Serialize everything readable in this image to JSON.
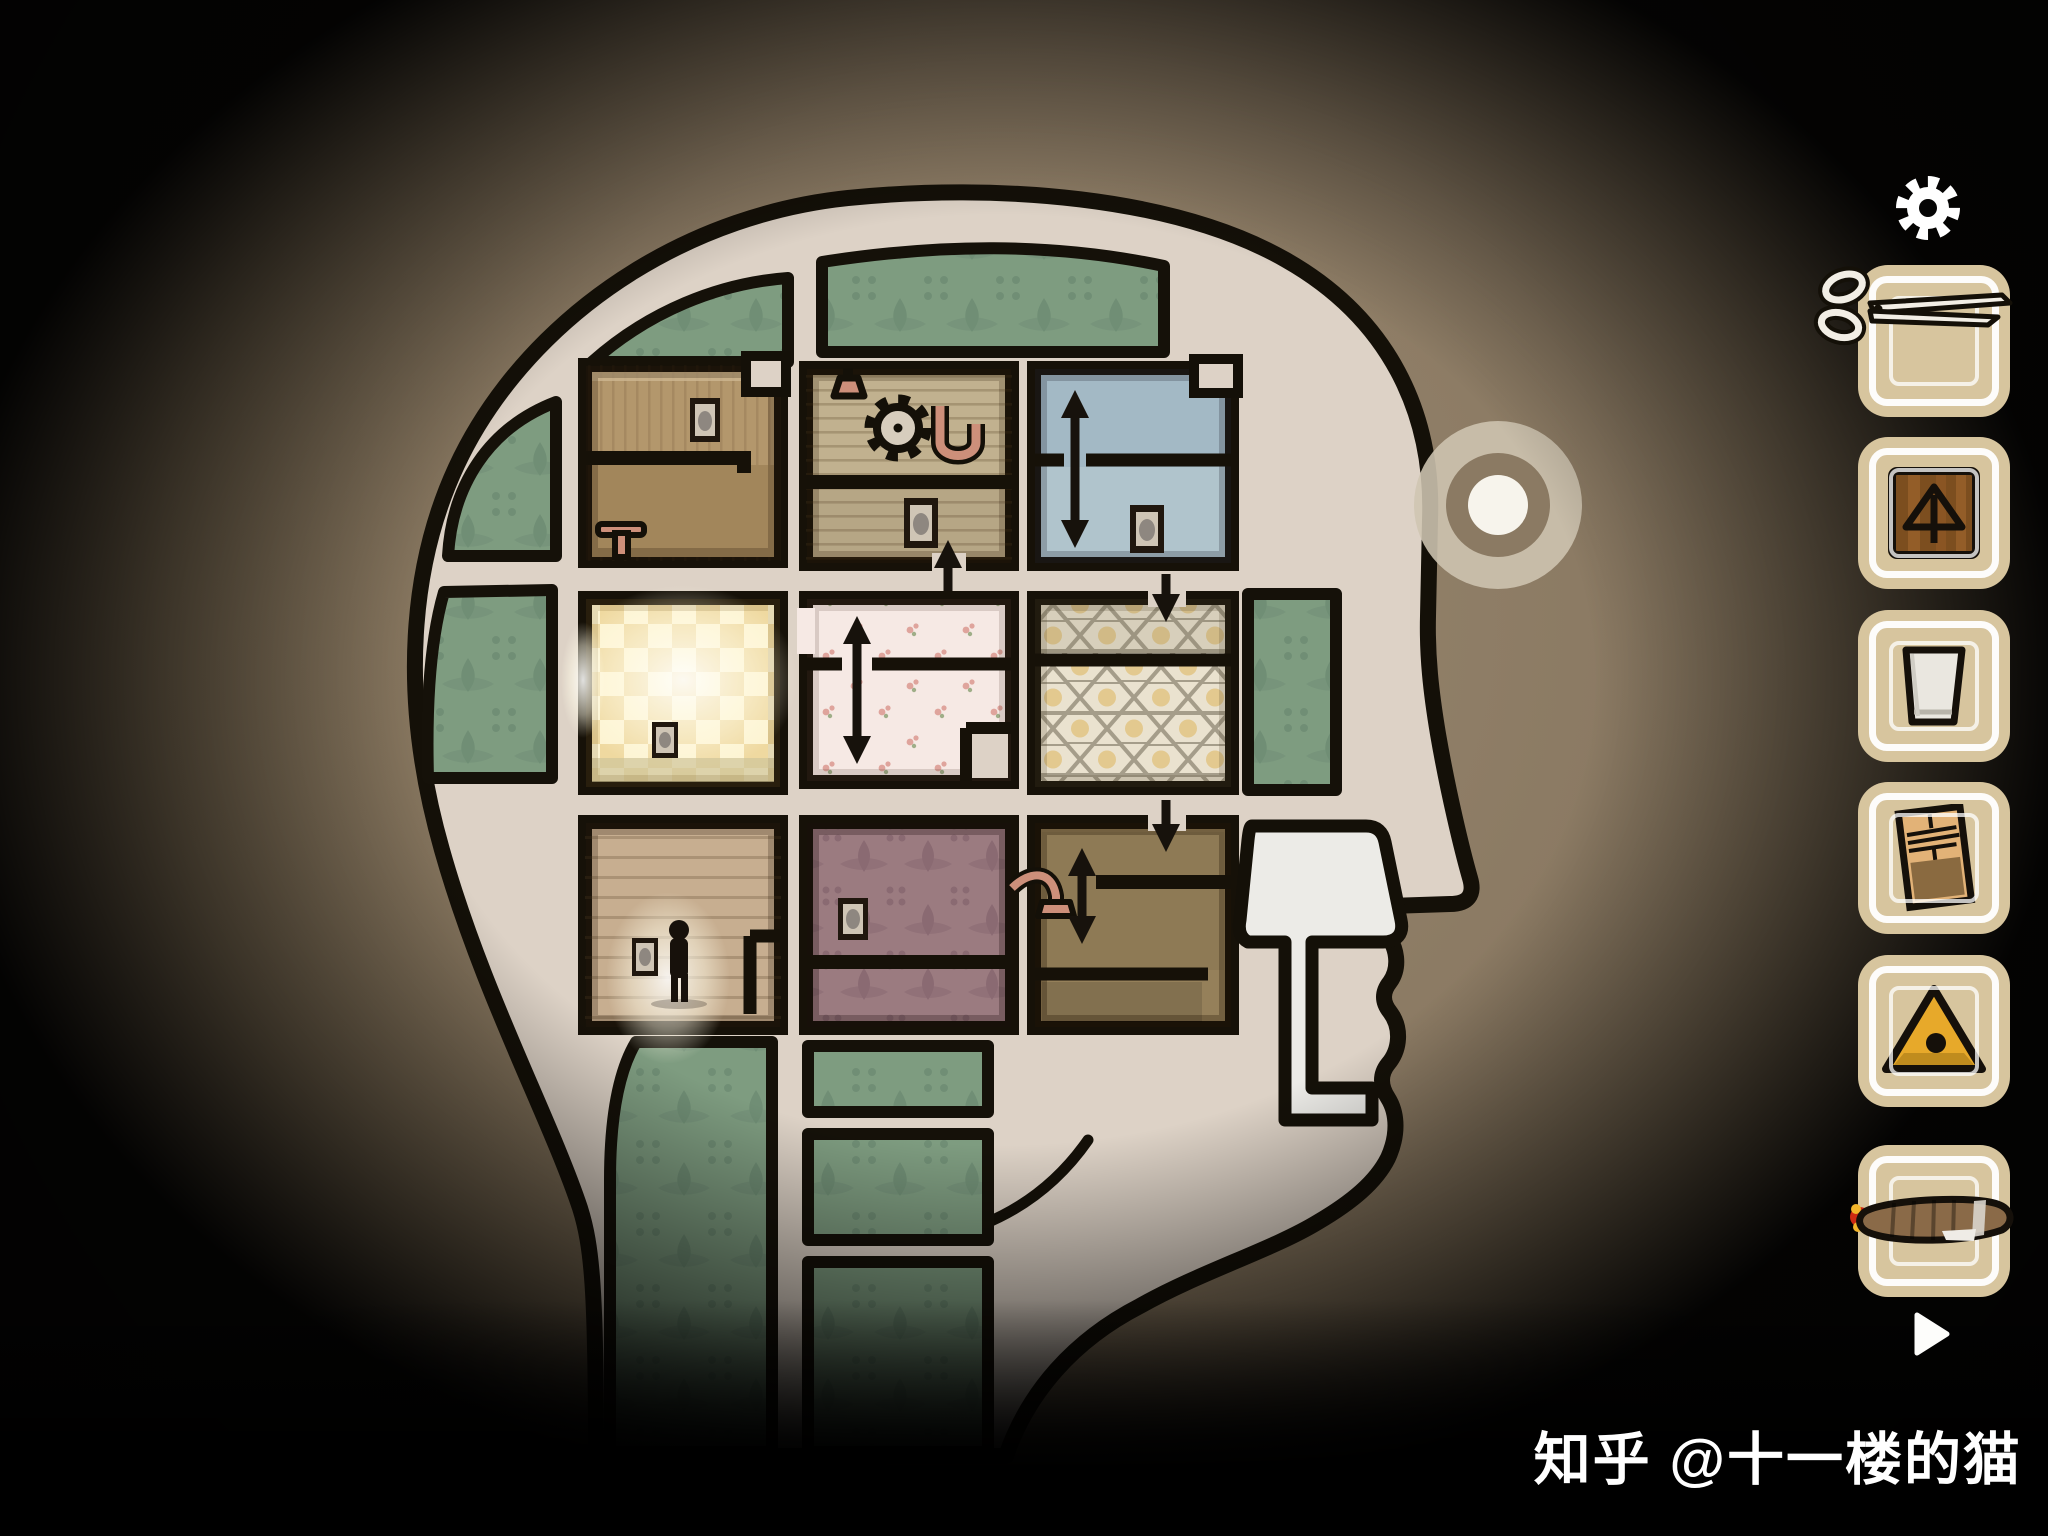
{
  "watermark": {
    "text": "知乎 @十一楼的猫"
  },
  "hud": {
    "settings_icon": "gear",
    "advance_icon": "play-triangle",
    "inventory": {
      "slot_count": 6,
      "items": [
        {
          "slot": 1,
          "name": "scissors",
          "selected": true
        },
        {
          "slot": 2,
          "name": "wooden box with arrow mark",
          "selected": false
        },
        {
          "slot": 3,
          "name": "empty drinking glass",
          "selected": false
        },
        {
          "slot": 4,
          "name": "paper document with photo",
          "selected": false
        },
        {
          "slot": 5,
          "name": "yellow triangle with black dot",
          "selected": false
        },
        {
          "slot": 6,
          "name": "lit cigar",
          "selected": false
        }
      ]
    }
  },
  "map": {
    "figure": "human head profile facing right, floor plan of nine rooms inside the skull",
    "ear_marker": "concentric circle target on temple",
    "nose_cavity": "white lamp-shaped passage near nose",
    "rooms": [
      {
        "id": "top-left",
        "wallpaper": "brown paneling",
        "features": [
          "picture-frame",
          "inner-ledge-wall",
          "stool"
        ]
      },
      {
        "id": "top-middle",
        "wallpaper": "wood slats",
        "features": [
          "hanging-lamp",
          "gear",
          "u-pipe",
          "picture-frame",
          "up-arrow"
        ]
      },
      {
        "id": "top-right",
        "wallpaper": "blue plaster",
        "features": [
          "vertical-double-arrow",
          "picture-frame",
          "split-level"
        ]
      },
      {
        "id": "middle-left",
        "wallpaper": "glowing yellow checkerboard",
        "features": [
          "picture-frame",
          "light-spill"
        ]
      },
      {
        "id": "middle-middle",
        "wallpaper": "pink floral",
        "features": [
          "vertical-double-arrow",
          "split-level"
        ]
      },
      {
        "id": "middle-right",
        "wallpaper": "honeycomb hexagons",
        "features": [
          "down-arrow",
          "split-level"
        ]
      },
      {
        "id": "bottom-left",
        "wallpaper": "wood boards",
        "features": [
          "standing-figure",
          "spotlight-glow",
          "picture-frame",
          "alcove-wall"
        ]
      },
      {
        "id": "bottom-middle",
        "wallpaper": "mauve damask",
        "features": [
          "picture-frame",
          "bottom-strip"
        ]
      },
      {
        "id": "bottom-right",
        "wallpaper": "olive brown",
        "features": [
          "down-arrow",
          "vertical-double-arrow",
          "elbow-pipe",
          "bottom-strip"
        ]
      }
    ],
    "green_panels": 9
  },
  "colors": {
    "background_brown": "#8b7a63",
    "head_fill": "#ddd2c6",
    "wall_black": "#161108",
    "panel_green": "#7e9c80",
    "room_blue": "#a3b9c5",
    "room_pink": "#f6e9e4",
    "room_mauve": "#9b7b80",
    "room_olive": "#95805a",
    "slot_cream": "#d7c59e",
    "triangle_yellow": "#e7a92a",
    "pipe_pink": "#cd8f7a",
    "watermark_white": "#ffffff"
  }
}
